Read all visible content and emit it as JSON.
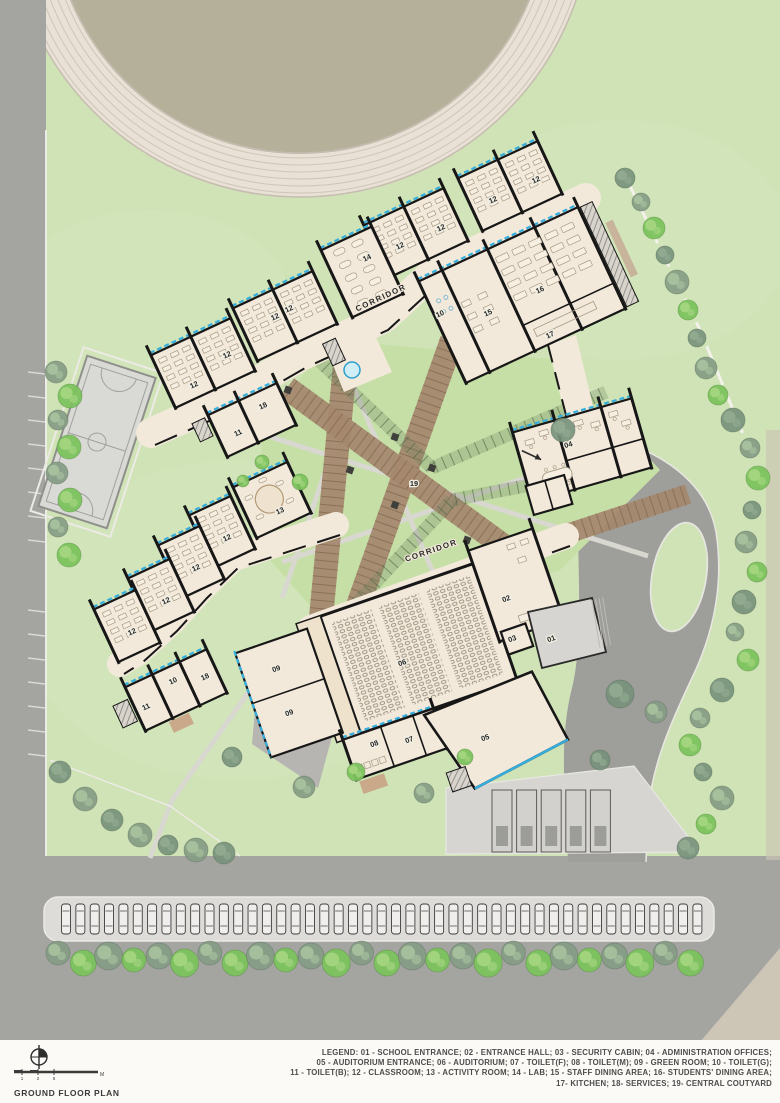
{
  "sheet": {
    "title": "GROUND FLOOR PLAN",
    "scale_bar": {
      "tick_labels": [
        "1",
        "2",
        "5"
      ],
      "unit_label": "M"
    },
    "legend_lines": [
      "LEGEND: 01 - SCHOOL ENTRANCE; 02 - ENTRANCE HALL; 03 - SECURITY CABIN; 04 - ADMINISTRATION OFFICES;",
      "05 - AUDITORIUM ENTRANCE; 06 - AUDITORIUM; 07 - TOILET(F); 08 - TOILET(M); 09 - GREEN ROOM; 10 - TOILET(G);",
      "11 - TOILET(B); 12 - CLASSROOM; 13 - ACTIVITY ROOM; 14 - LAB; 15 - STAFF DINING AREA; 16- STUDENTS' DINING AREA;",
      "17- KITCHEN; 18- SERVICES; 19- CENTRAL COUTYARD"
    ]
  },
  "plan": {
    "corridor_labels": [
      {
        "text": "CORRIDOR",
        "x": 382,
        "y": 300,
        "rot": -25
      },
      {
        "text": "CORRIDOR",
        "x": 432,
        "y": 553,
        "rot": -19
      }
    ],
    "room_labels": [
      {
        "num": "12",
        "x": 195,
        "y": 387,
        "rot": -25
      },
      {
        "num": "12",
        "x": 228,
        "y": 357,
        "rot": -25
      },
      {
        "num": "12",
        "x": 276,
        "y": 319,
        "rot": -25
      },
      {
        "num": "12",
        "x": 290,
        "y": 311,
        "rot": -25
      },
      {
        "num": "14",
        "x": 368,
        "y": 260,
        "rot": -25
      },
      {
        "num": "12",
        "x": 401,
        "y": 248,
        "rot": -25
      },
      {
        "num": "12",
        "x": 442,
        "y": 230,
        "rot": -25
      },
      {
        "num": "12",
        "x": 494,
        "y": 202,
        "rot": -25
      },
      {
        "num": "12",
        "x": 537,
        "y": 182,
        "rot": -25
      },
      {
        "num": "10",
        "x": 441,
        "y": 316,
        "rot": -25
      },
      {
        "num": "15",
        "x": 489,
        "y": 315,
        "rot": -25
      },
      {
        "num": "16",
        "x": 541,
        "y": 292,
        "rot": -25
      },
      {
        "num": "17",
        "x": 551,
        "y": 337,
        "rot": -25
      },
      {
        "num": "18",
        "x": 264,
        "y": 408,
        "rot": -25
      },
      {
        "num": "11",
        "x": 239,
        "y": 435,
        "rot": -25
      },
      {
        "num": "13",
        "x": 281,
        "y": 513,
        "rot": -25
      },
      {
        "num": "12",
        "x": 228,
        "y": 540,
        "rot": -25
      },
      {
        "num": "12",
        "x": 197,
        "y": 570,
        "rot": -25
      },
      {
        "num": "12",
        "x": 167,
        "y": 603,
        "rot": -25
      },
      {
        "num": "12",
        "x": 133,
        "y": 634,
        "rot": -25
      },
      {
        "num": "10",
        "x": 174,
        "y": 683,
        "rot": -25
      },
      {
        "num": "18",
        "x": 206,
        "y": 679,
        "rot": -25
      },
      {
        "num": "11",
        "x": 147,
        "y": 709,
        "rot": -25
      },
      {
        "num": "19",
        "x": 414,
        "y": 486,
        "rot": 0
      },
      {
        "num": "04",
        "x": 569,
        "y": 447,
        "rot": -16
      },
      {
        "num": "02",
        "x": 507,
        "y": 601,
        "rot": -19
      },
      {
        "num": "03",
        "x": 513,
        "y": 641,
        "rot": -19
      },
      {
        "num": "01",
        "x": 552,
        "y": 641,
        "rot": -19
      },
      {
        "num": "06",
        "x": 403,
        "y": 665,
        "rot": -19
      },
      {
        "num": "09",
        "x": 277,
        "y": 671,
        "rot": -19
      },
      {
        "num": "09",
        "x": 290,
        "y": 715,
        "rot": -19
      },
      {
        "num": "08",
        "x": 375,
        "y": 746,
        "rot": -19
      },
      {
        "num": "07",
        "x": 410,
        "y": 742,
        "rot": -19
      },
      {
        "num": "05",
        "x": 486,
        "y": 740,
        "rot": -19
      }
    ],
    "parking": {
      "car_count": 45,
      "bus_bay_count": 5
    },
    "colors": {
      "grass": "#cfe3b6",
      "courtyard_grass": "#c6dfa6",
      "road": "#a4a4a1",
      "driveway": "#9e9e9b",
      "parking_strip": "#dddcd9",
      "building_floor": "#f2e9da",
      "wall": "#171717",
      "window_blue": "#35aede",
      "pergola_brown": "#a5886e",
      "track_lane": "#e9e1d6",
      "track_infield": "#b4b09a",
      "court_gray": "#d9d9d5",
      "tan_path": "#cdc5b6"
    }
  }
}
